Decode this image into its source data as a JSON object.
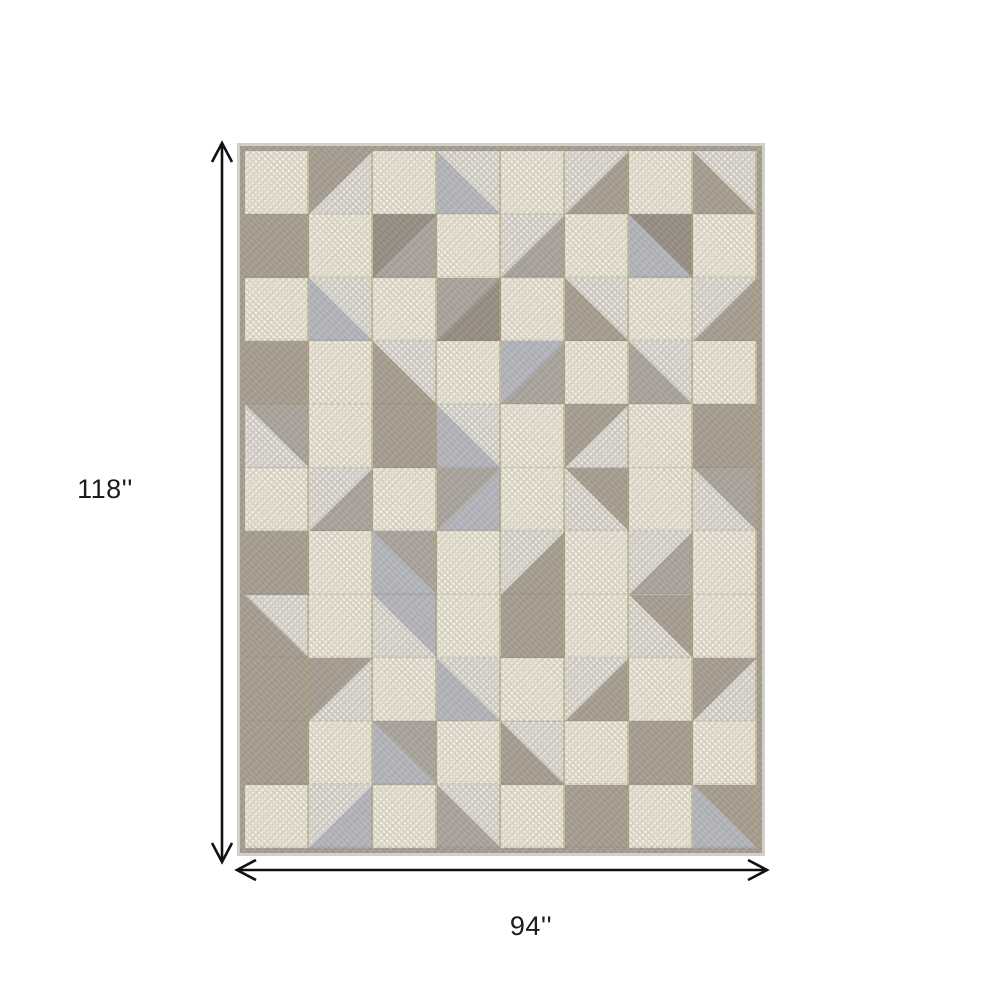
{
  "page": {
    "background": "#ffffff",
    "description": "Product dimension image of a geometric patchwork area rug"
  },
  "dimension_annotations": {
    "height": {
      "label": "118''"
    },
    "width": {
      "label": "94''"
    },
    "arrow_color": "#111111",
    "label_color": "#1c1c1c"
  },
  "rug": {
    "columns": 8,
    "rows": 11,
    "edge_color": "#d2cfc7",
    "fringe_color": "#a59c90",
    "gold_line_color": "rgba(172,162,104,0.55)",
    "row_line_color": "rgba(110,100,88,0.14)",
    "palette": {
      "c": "#ded9c8",
      "c_dot": "#f3f0e4",
      "t": "#a69c8f",
      "g": "#a8a29b",
      "l": "#d2cec6",
      "b": "#b2b4ba",
      "d": "#968c80"
    },
    "cells": [
      [
        "c",
        "t+l:br",
        "c",
        "l+b:bl",
        "c",
        "l+t:br",
        "c",
        "t+l:tr"
      ],
      [
        "t",
        "c",
        "g+d:tl",
        "c",
        "l+g:br",
        "c",
        "b+d:tr",
        "c"
      ],
      [
        "c",
        "l+b:bl",
        "c",
        "g+d:br",
        "c",
        "l+t:bl",
        "c",
        "t+l:tl"
      ],
      [
        "t",
        "c",
        "t+l:tr",
        "c",
        "g+b:tl",
        "c",
        "l+g:bl",
        "c"
      ],
      [
        "g+l:bl",
        "c",
        "t",
        "l+b:bl",
        "c",
        "t+l:br",
        "c",
        "t"
      ],
      [
        "c",
        "l+g:br",
        "c",
        "b+g:tl",
        "c",
        "l+t:tr",
        "c",
        "g+l:bl"
      ],
      [
        "t",
        "c",
        "g+b:bl",
        "c",
        "t+l:tl",
        "c",
        "l+g:br",
        "c"
      ],
      [
        "t+l:tr",
        "c",
        "l+b:tr",
        "c",
        "t",
        "c",
        "l+t:tr",
        "c"
      ],
      [
        "t",
        "t+l:br",
        "c",
        "l+b:bl",
        "c",
        "l+t:br",
        "c",
        "t+l:br"
      ],
      [
        "t",
        "c",
        "g+b:bl",
        "c",
        "t+l:tr",
        "c",
        "t",
        "c"
      ],
      [
        "c",
        "l+b:br",
        "c",
        "g+l:tr",
        "c",
        "t",
        "c",
        "t+b:bl"
      ]
    ]
  }
}
